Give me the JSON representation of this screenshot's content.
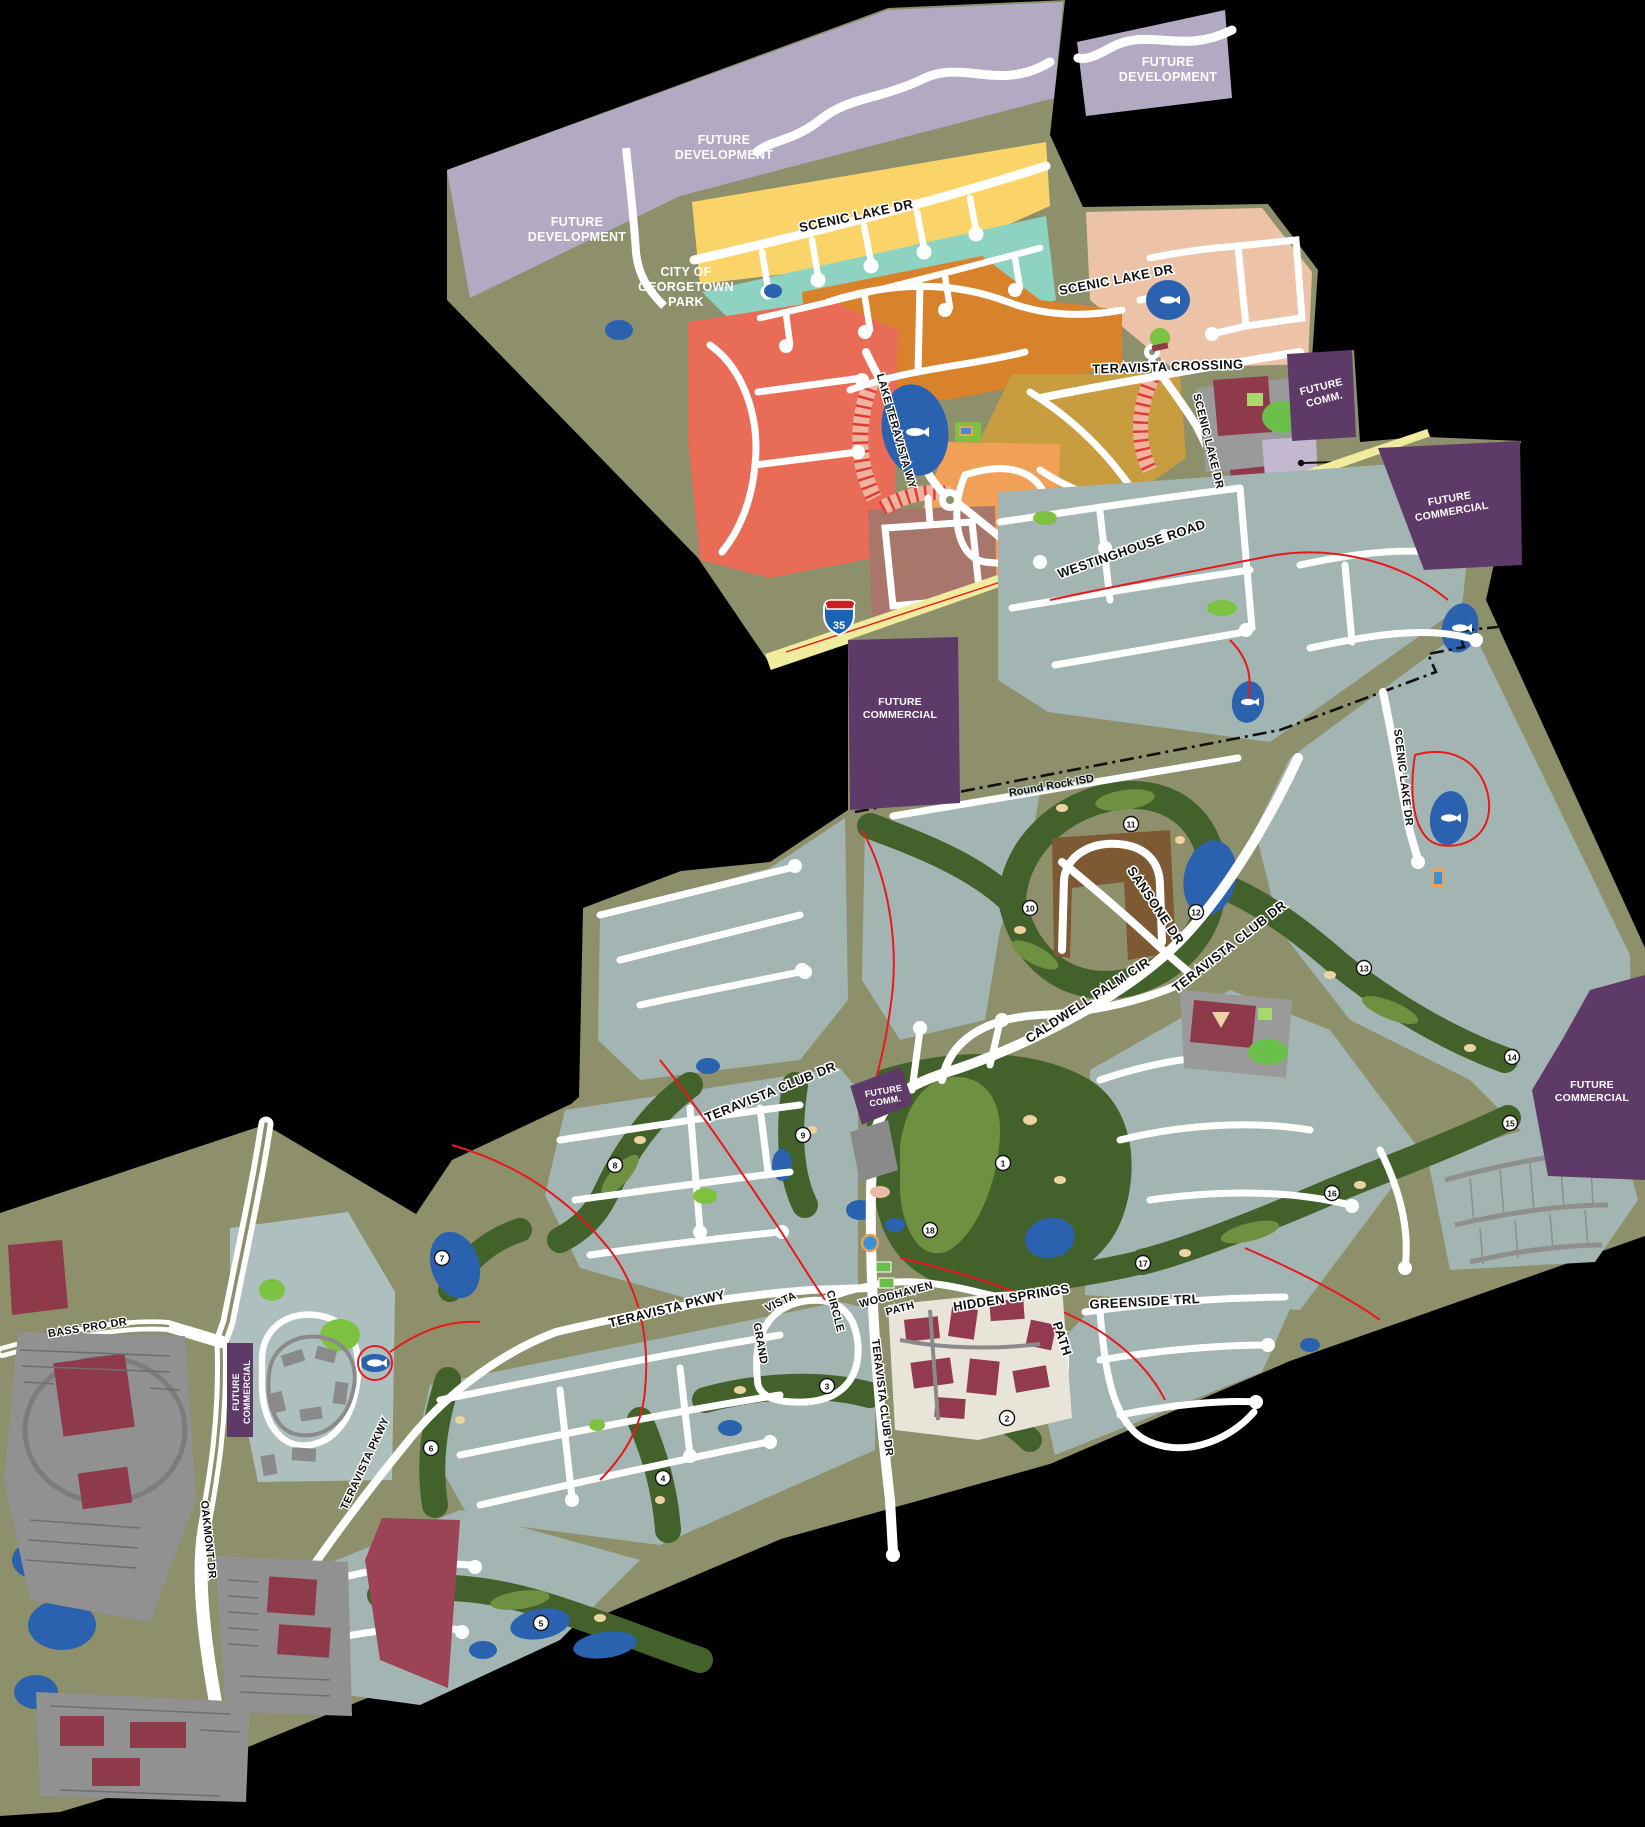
{
  "map_title": "Teravista master-planned community site map",
  "areas": {
    "future_development": {
      "l1": "FUTURE",
      "l2": "DEVELOPMENT"
    },
    "georgetown_park": {
      "l1": "CITY OF",
      "l2": "GEORGETOWN",
      "l3": "PARK"
    },
    "future_commercial": {
      "l1": "FUTURE",
      "l2": "COMMERCIAL"
    },
    "future_comm_abbr": {
      "l1": "FUTURE",
      "l2": "COMM."
    }
  },
  "roads": {
    "scenic_lake_dr": "SCENIC LAKE DR",
    "teravista_crossing": "TERAVISTA CROSSING",
    "westinghouse_road": "WESTINGHOUSE  ROAD",
    "lake_teravista_wy": "LAKE TERAVISTA WY",
    "sansone_dr": "SANSONE DR",
    "teravista_club_dr": "TERAVISTA CLUB DR",
    "caldwell_palm_cir": "CALDWELL PALM CIR",
    "teravista_pkwy": "TERAVISTA PKWY",
    "grand": "GRAND",
    "vista": "VISTA",
    "circle": "CIRCLE",
    "woodhaven": "WOODHAVEN",
    "path": "PATH",
    "hidden_springs": "HIDDEN  SPRINGS",
    "greenside_trl": "GREENSIDE TRL",
    "oakmont_dr": "OAKMONT  DR",
    "bass_pro_dr": "BASS PRO DR"
  },
  "boundary": {
    "round_rock_isd": "Round Rock ISD"
  },
  "highway": {
    "i35": "35"
  },
  "golf_holes": [
    {
      "num": "1"
    },
    {
      "num": "2"
    },
    {
      "num": "3"
    },
    {
      "num": "4"
    },
    {
      "num": "5"
    },
    {
      "num": "6"
    },
    {
      "num": "7"
    },
    {
      "num": "8"
    },
    {
      "num": "9"
    },
    {
      "num": "10"
    },
    {
      "num": "11"
    },
    {
      "num": "12"
    },
    {
      "num": "13"
    },
    {
      "num": "14"
    },
    {
      "num": "15"
    },
    {
      "num": "16"
    },
    {
      "num": "17"
    },
    {
      "num": "18"
    }
  ],
  "colors": {
    "background": "#000000",
    "open_space_olive": "#8e906c",
    "future_development_lavender": "#b3a9c3",
    "future_commercial_purple": "#5e3a68",
    "residential_gray_blue": "#a2b5b3",
    "neighborhood_yellow": "#fbd469",
    "neighborhood_teal": "#8ed2c2",
    "neighborhood_pink": "#edc3a8",
    "neighborhood_orange": "#d9822c",
    "neighborhood_salmon": "#e86c56",
    "neighborhood_gold": "#c79d3f",
    "neighborhood_lt_orange": "#f0a057",
    "neighborhood_mauve": "#a8766a",
    "golf_dark_green": "#42612b",
    "golf_light_green": "#6d9140",
    "park_bright_green": "#7dc141",
    "water_blue": "#2a62b0",
    "road_white": "#ffffff",
    "westinghouse_yellow": "#f1eb9e",
    "trail_red": "#e8191c",
    "building_dark_red": "#8e3a4a",
    "parking_gray": "#919191",
    "clubhouse_brown": "#7d5a33"
  }
}
